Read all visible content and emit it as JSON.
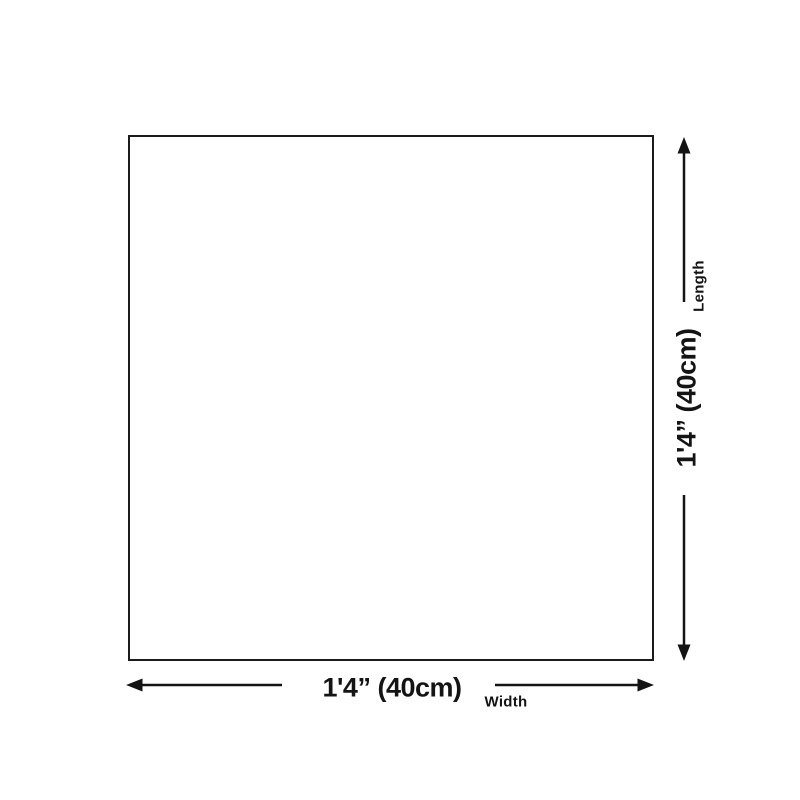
{
  "diagram": {
    "kind": "product-dimension-diagram",
    "dimensions": {
      "width": {
        "value": "1'4” (40cm)",
        "axis_label": "Width"
      },
      "length": {
        "value": "1'4” (40cm)",
        "axis_label": "Length"
      }
    },
    "icons": {
      "arrow_up": "triangle-up-arrowhead",
      "arrow_down": "triangle-down-arrowhead",
      "arrow_left": "triangle-left-arrowhead",
      "arrow_right": "triangle-right-arrowhead"
    },
    "colors": {
      "background": "#ffffff",
      "box_border": "#1b1b1b",
      "line": "#141414",
      "text": "#141414"
    }
  }
}
